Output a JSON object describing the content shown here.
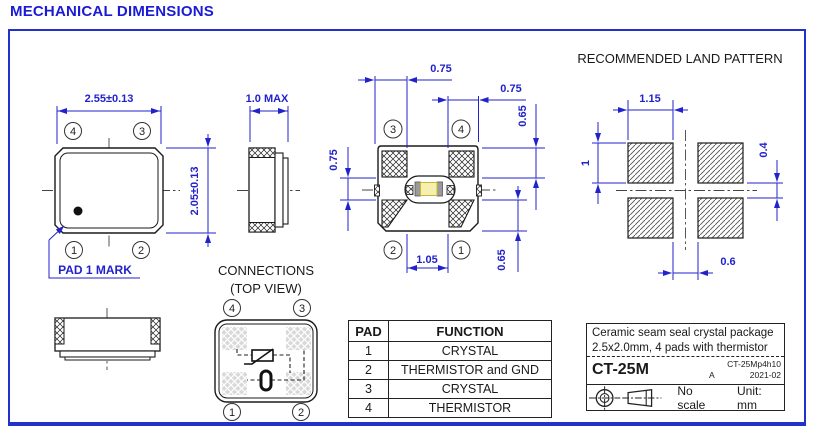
{
  "title": "MECHANICAL DIMENSIONS",
  "colors": {
    "dimension_blue": "#2222cc",
    "line_black": "#1a1a1a",
    "border_blue": "#2230cc"
  },
  "top_view": {
    "dim_width": "2.55±0.13",
    "dim_height": "2.05±0.13",
    "pad_mark_label": "PAD 1 MARK",
    "pad_numbers": {
      "top_left": "4",
      "top_right": "3",
      "bottom_left": "1",
      "bottom_right": "2"
    }
  },
  "side_view": {
    "dim_thickness": "1.0 MAX"
  },
  "bottom_view": {
    "dim_pad_width_left": "0.75",
    "dim_pad_width_right": "0.75",
    "dim_pad_gap_left": "0.75",
    "dim_pad_height_top": "0.65",
    "dim_pad_height_bottom": "0.65",
    "dim_pad_gap_bottom": "1.05",
    "pad_numbers": {
      "top_left": "3",
      "top_right": "4",
      "bottom_left": "2",
      "bottom_right": "1"
    }
  },
  "land_pattern": {
    "title": "RECOMMENDED LAND PATTERN",
    "dim_pad_width": "1.15",
    "dim_pad_height": "1",
    "dim_row_gap": "0.4",
    "dim_col_gap": "0.6"
  },
  "connections": {
    "title": "CONNECTIONS",
    "subtitle": "(TOP VIEW)",
    "pad_numbers": {
      "top_left": "4",
      "top_right": "3",
      "bottom_left": "1",
      "bottom_right": "2"
    }
  },
  "pad_table": {
    "headers": [
      "PAD",
      "FUNCTION"
    ],
    "rows": [
      [
        "1",
        "CRYSTAL"
      ],
      [
        "2",
        "THERMISTOR and GND"
      ],
      [
        "3",
        "CRYSTAL"
      ],
      [
        "4",
        "THERMISTOR"
      ]
    ]
  },
  "title_block": {
    "description_line1": "Ceramic seam seal crystal package",
    "description_line2": "2.5x2.0mm, 4 pads with thermistor",
    "part_number": "CT-25M",
    "document_number": "CT-25Mp4h10",
    "revision": "A",
    "date": "2021-02",
    "scale_note": "No scale",
    "unit_note": "Unit: mm"
  }
}
